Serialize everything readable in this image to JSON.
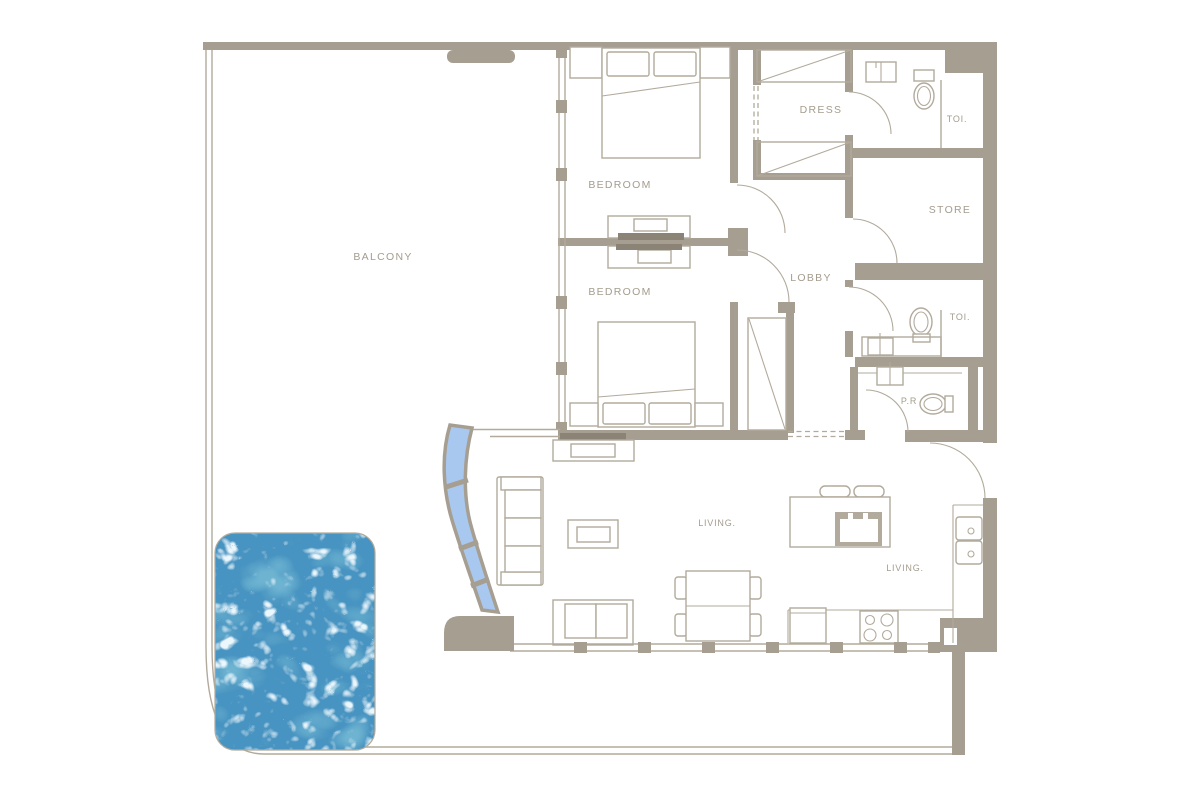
{
  "plan": {
    "title": "Apartment floor plan with balcony and pool",
    "labels": {
      "balcony": "BALCONY",
      "bedroom_top": "BEDROOM",
      "bedroom_bottom": "BEDROOM",
      "dress": "DRESS",
      "toilet_top": "TOI.",
      "store": "STORE",
      "lobby": "LOBBY",
      "toilet_middle": "TOI.",
      "powder_room": "P.R",
      "living_left": "LIVING.",
      "living_right": "LIVING."
    },
    "colors": {
      "wall": "#a69e90",
      "line": "#b2aa9c",
      "text": "#a49c8e",
      "glass": "#a9c8f0",
      "pool_base": "#4793c1",
      "pool_deep": "#2e7ca8",
      "pool_light": "#e9f8ff",
      "tv": "#8b8376",
      "background": "#ffffff"
    }
  }
}
